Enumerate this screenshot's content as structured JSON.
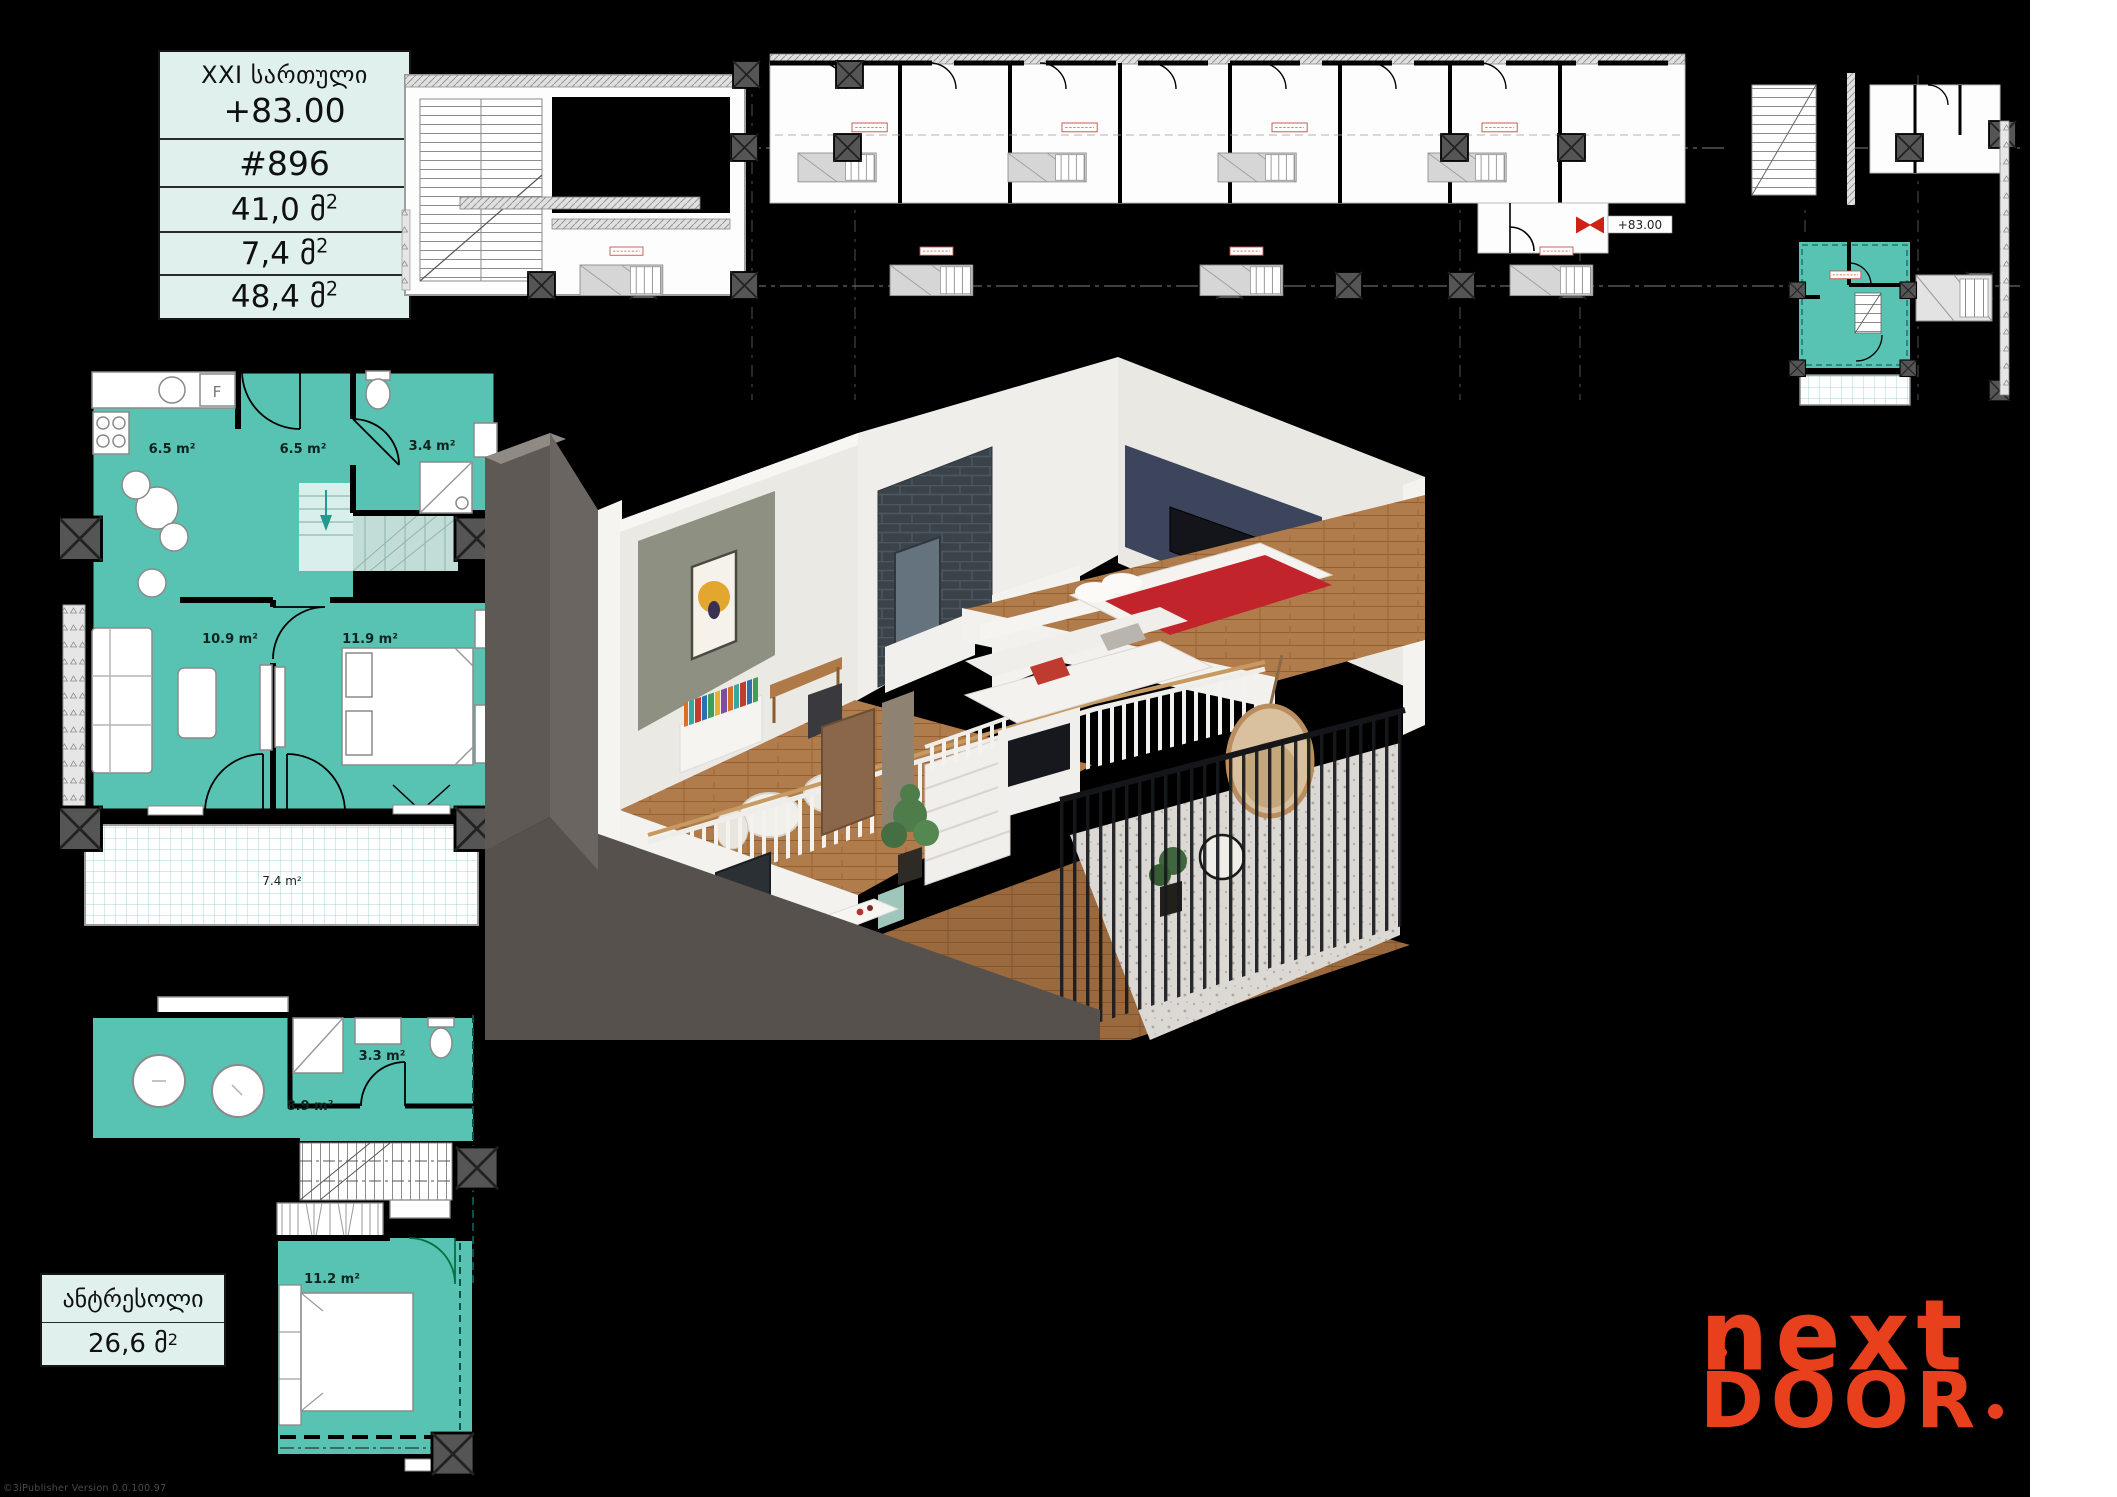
{
  "page": {
    "background": "#000000",
    "side_strip": "#ffffff"
  },
  "info_table": {
    "floor_label": "XXI სართული",
    "elevation": "+83.00",
    "unit_number": "#896",
    "rows": [
      {
        "main": "41,0 მ",
        "sup": "2"
      },
      {
        "main": "7,4 მ",
        "sup": "2"
      },
      {
        "main": "48,4 მ",
        "sup": "2"
      }
    ]
  },
  "building_plan": {
    "elevation_marker": "+83.00",
    "highlight_color": "#58c2b3"
  },
  "upper_plan": {
    "kitchen_area": "6.5 m²",
    "hall_area": "6.5 m²",
    "bathroom_area": "3.4 m²",
    "living_area": "10.9 m²",
    "bedroom_area": "11.9 m²",
    "balcony_area": "7.4 m²",
    "fridge_label": "F",
    "fill_color": "#58c2b3"
  },
  "mezzanine_plan": {
    "hall_area": "8.9 m²",
    "bathroom_area": "3.3 m²",
    "bedroom_area": "11.2 m²",
    "fill_color": "#58c2b3"
  },
  "mezzanine_table": {
    "title": "ანტრესოლი",
    "area_main": "26,6 მ",
    "area_sup": "2"
  },
  "logo": {
    "line1": "next",
    "line2": "DOOR",
    "dot": ".",
    "color": "#e8401c"
  },
  "watermark": "©3iPublisher Version 0.0.100.97"
}
